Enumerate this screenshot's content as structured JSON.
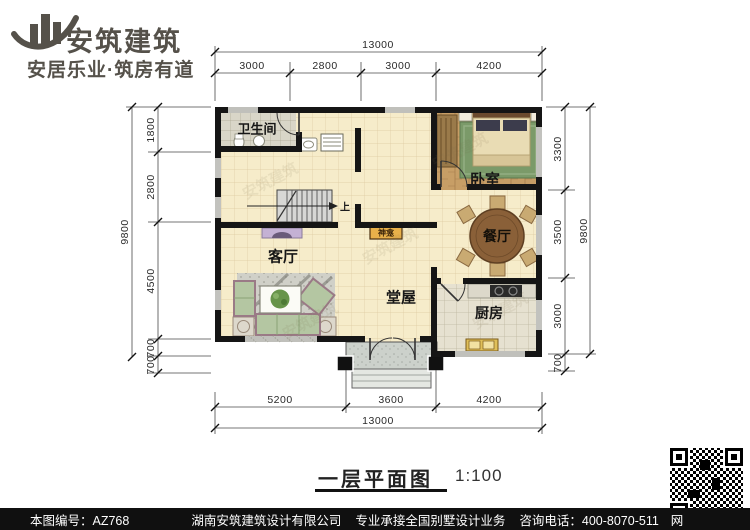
{
  "brand": {
    "name": "安筑建筑",
    "tagline": "安居乐业·筑房有道"
  },
  "watermark": "安筑建筑",
  "rooms": {
    "bathroom": "卫生间",
    "bedroom": "卧室",
    "living": "客厅",
    "dining": "餐厅",
    "hall": "堂屋",
    "kitchen": "厨房",
    "shrine": "神龛",
    "stair_up": "上"
  },
  "dims": {
    "top_total": "13000",
    "top_segs": [
      "3000",
      "2800",
      "3000",
      "4200"
    ],
    "bottom_total": "13000",
    "bottom_segs": [
      "5200",
      "3600",
      "4200"
    ],
    "left_total": "9800",
    "left_segs": [
      "1800",
      "2800",
      "4500",
      "700",
      "700"
    ],
    "right_total": "9800",
    "right_segs": [
      "3300",
      "3500",
      "3000",
      "700"
    ]
  },
  "caption": {
    "title": "一层平面图",
    "scale": "1:100"
  },
  "footer": {
    "sheet_no": "本图编号：AZ768",
    "company": "湖南安筑建筑设计有限公司",
    "service": "专业承接全国别墅设计业务",
    "phone": "咨询电话：400-8070-511",
    "web_mark": "网"
  },
  "colors": {
    "wall": "#151515",
    "floor_tile": "#f6ecca",
    "bath_tile": "#d9d6c8",
    "wood": "#c79e66",
    "accent_shrine": "#e8b04a",
    "brand_gray": "#55514a"
  }
}
